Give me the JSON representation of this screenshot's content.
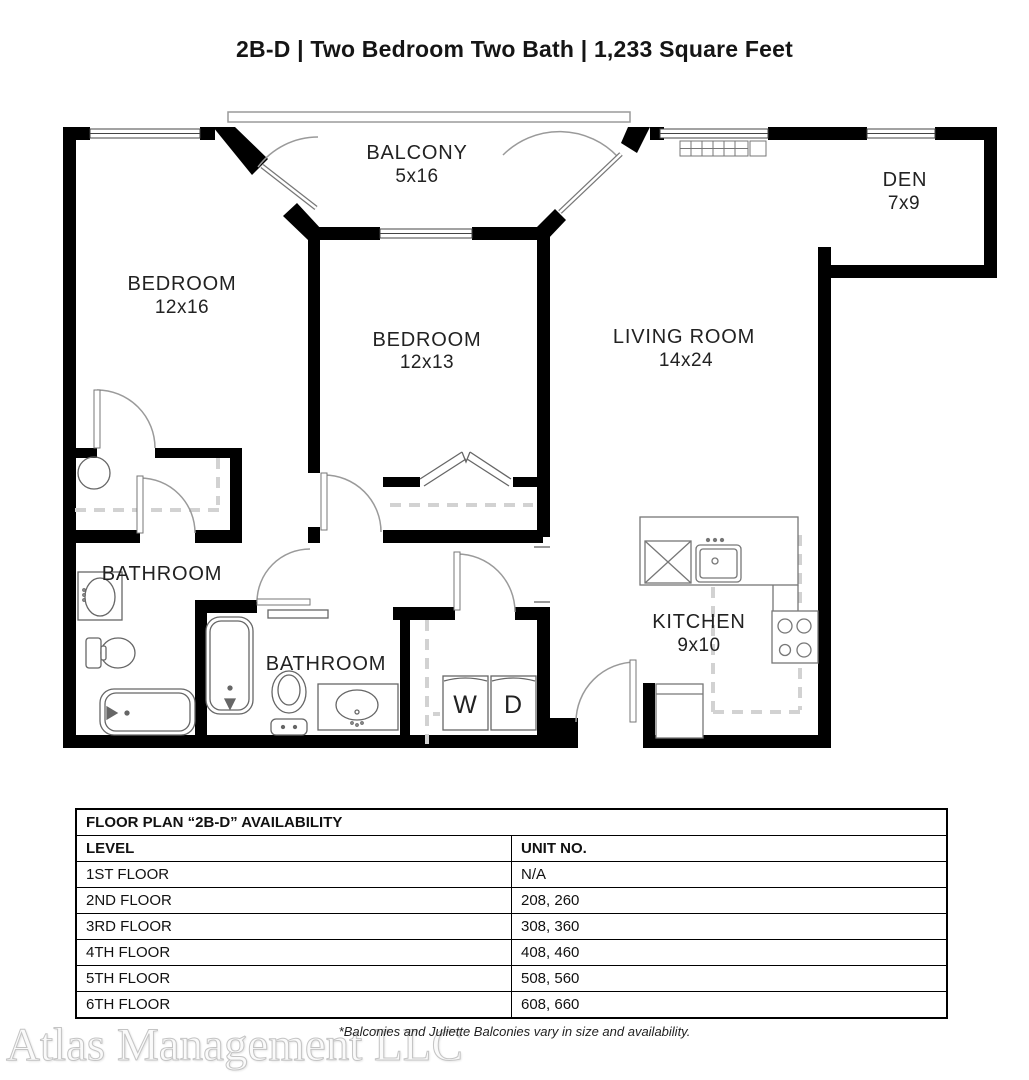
{
  "title": "2B-D | Two Bedroom Two Bath | 1,233 Square Feet",
  "plan": {
    "rooms": [
      {
        "name": "BALCONY",
        "dims": "5x16"
      },
      {
        "name": "DEN",
        "dims": "7x9"
      },
      {
        "name": "BEDROOM",
        "dims": "12x16"
      },
      {
        "name": "BEDROOM",
        "dims": "12x13"
      },
      {
        "name": "LIVING ROOM",
        "dims": "14x24"
      },
      {
        "name": "BATHROOM"
      },
      {
        "name": "BATHROOM"
      },
      {
        "name": "KITCHEN",
        "dims": "9x10"
      }
    ],
    "laundry": {
      "washer_label": "W",
      "dryer_label": "D"
    }
  },
  "availability_table": {
    "title": "FLOOR PLAN “2B-D” AVAILABILITY",
    "columns": [
      "LEVEL",
      "UNIT NO."
    ],
    "rows": [
      {
        "level": "1ST FLOOR",
        "units": "N/A"
      },
      {
        "level": "2ND FLOOR",
        "units": "208, 260"
      },
      {
        "level": "3RD FLOOR",
        "units": "308, 360"
      },
      {
        "level": "4TH FLOOR",
        "units": "408, 460"
      },
      {
        "level": "5TH FLOOR",
        "units": "508, 560"
      },
      {
        "level": "6TH FLOOR",
        "units": "608, 660"
      }
    ]
  },
  "footnote": "*Balconies and Juliette Balconies vary in size and availability.",
  "watermark": "Atlas Management LLC",
  "colors": {
    "wall": "#000000",
    "thin_line": "#777777",
    "dashed_line": "#d2d2d2",
    "text": "#1d1d1d"
  }
}
